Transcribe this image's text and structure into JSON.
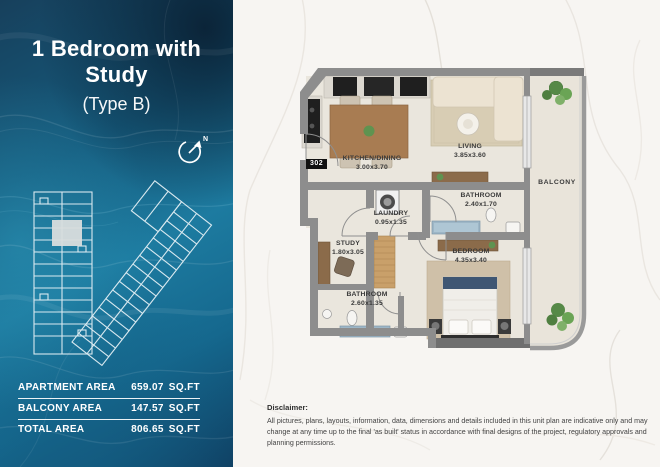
{
  "header": {
    "title": "1 Bedroom with Study",
    "subtitle": "(Type B)"
  },
  "compass": {
    "label": "N"
  },
  "area_table": {
    "rows": [
      {
        "label": "APARTMENT AREA",
        "value": "659.07",
        "unit": "SQ.FT"
      },
      {
        "label": "BALCONY AREA",
        "value": "147.57",
        "unit": "SQ.FT"
      },
      {
        "label": "TOTAL AREA",
        "value": "806.65",
        "unit": "SQ.FT"
      }
    ]
  },
  "floorplan": {
    "unit_number": "302",
    "rooms": [
      {
        "name": "KITCHEN/DINING",
        "dims": "3.00x3.70"
      },
      {
        "name": "LIVING",
        "dims": "3.85x3.60"
      },
      {
        "name": "BALCONY",
        "dims": ""
      },
      {
        "name": "BATHROOM",
        "dims": "2.40x1.70"
      },
      {
        "name": "LAUNDRY",
        "dims": "0.95x1.35"
      },
      {
        "name": "STUDY",
        "dims": "1.80x3.05"
      },
      {
        "name": "BEDROOM",
        "dims": "4.35x3.40"
      },
      {
        "name": "BATHROOM",
        "dims": "2.60x1.35"
      }
    ]
  },
  "disclaimer": {
    "heading": "Disclaimer:",
    "body": "All pictures, plans, layouts, information, data, dimensions and details included in this unit plan are indicative only and may change at any time up to the final 'as built' status  in accordance with final designs of the project, regulatory approvals and planning  permissions."
  },
  "colors": {
    "panel_teal": "#1d7ba0",
    "panel_navy": "#132f48",
    "wall_gray": "#8d8d8d",
    "floor_cream": "#eae6dd",
    "wood_brown": "#a87c52",
    "plant_green": "#5f9350",
    "water_blue": "#9db6c6"
  }
}
